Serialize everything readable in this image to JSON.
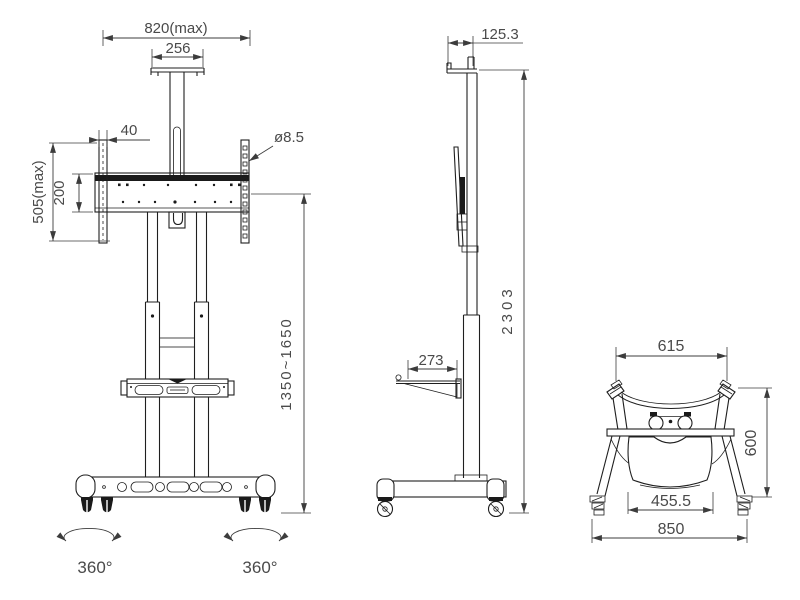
{
  "drawing": {
    "front_view": {
      "dims": {
        "overall_width_max": "820(max)",
        "top_plate_width": "256",
        "bracket_width": "40",
        "hole_diameter": "ø8.5",
        "bracket_height_max": "505(max)",
        "vesa_spacing": "200",
        "height_range": "1350~1650",
        "caster_rotation_left": "360°",
        "caster_rotation_right": "360°"
      }
    },
    "side_view": {
      "dims": {
        "top_shelf_depth": "125.3",
        "overall_height": "2303",
        "shelf_depth": "273"
      }
    },
    "top_view": {
      "dims": {
        "frame_width": "615",
        "base_depth": "600",
        "tray_width": "455.5",
        "overall_width": "850"
      }
    },
    "colors": {
      "line": "#1f1f1f",
      "dim_line": "#3c3c3c",
      "text": "#4a4a4a",
      "background": "#ffffff"
    }
  }
}
